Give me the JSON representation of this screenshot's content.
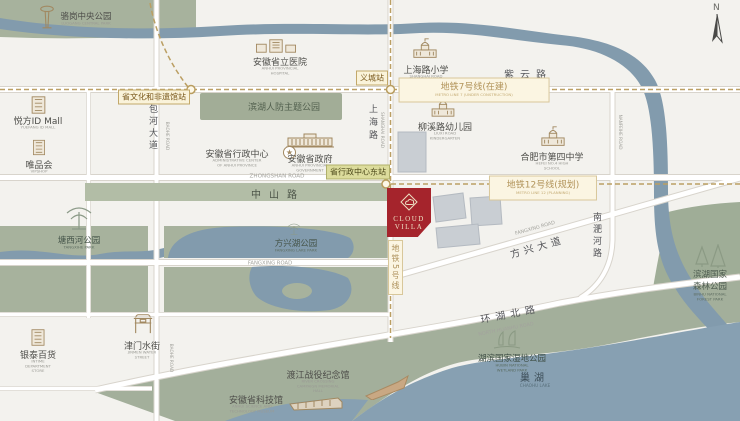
{
  "map": {
    "compass": "N",
    "badge": {
      "line1": "CLOUD",
      "line2": "VILLA"
    },
    "colors": {
      "badge_red": "#a5242c",
      "park_green": "#a7b29d",
      "water_blue": "#87a0b2",
      "metro_tan": "#bb9f63",
      "road_white": "#ffffff"
    },
    "parks": {
      "luogang": {
        "zh": "骆岗中央公园",
        "en": "LUOGANG CENTRAL PARK"
      },
      "renfang": {
        "zh": "滨湖人防主题公园"
      },
      "tangxihe": {
        "zh": "塘西河公园",
        "en": "TANGXIHE PARK"
      },
      "fangxinghu": {
        "zh": "方兴湖公园",
        "en": "FANGXING LAKE PARK"
      },
      "forest": {
        "zh": "滨湖国家森林公园",
        "en": "BINHU NATIONAL FOREST PARK"
      },
      "wetland": {
        "zh": "湖滨国家湿地公园",
        "en": "HUBIN NATIONAL WETLAND PARK"
      }
    },
    "pois": {
      "hospital": {
        "zh": "安徽省立医院",
        "en": "ANHUI PROVINCIAL HOSPITAL"
      },
      "primary": {
        "zh": "上海路小学",
        "en": "SHANGHAI ROAD PRIMARY SCHOOL"
      },
      "kindergarten": {
        "zh": "柳溪路幼儿园",
        "en": "LIUXI ROAD KINDERGARTEN"
      },
      "no4": {
        "zh": "合肥市第四中学",
        "en": "HEFEI NO.4 HIGH SCHOOL"
      },
      "yuefang": {
        "zh": "悦方ID Mall",
        "en": "YUEFANG ID MALL"
      },
      "vipshop": {
        "zh": "唯品会",
        "en": "VIPSHOP"
      },
      "intime": {
        "zh": "银泰百货",
        "en": "INTIME DEPARTMENT STORE"
      },
      "jinmen": {
        "zh": "津门水街",
        "en": "JINMEN WATER STREET"
      },
      "admin": {
        "zh": "安徽省行政中心",
        "en": "ADMINISTRATIVE CENTER OF ANHUI PROVINCE"
      },
      "gov": {
        "zh": "安徽省政府",
        "en": "ANHUI PROVINCIAL GOVERNMENT"
      },
      "memorial": {
        "zh": "渡江战役纪念馆",
        "en": "RIVER CROSSING CAMPAIGN MEMORIAL HALL"
      },
      "scitech": {
        "zh": "安徽省科技馆",
        "en": "ANHUI SCIENCE AND TECHNOLOGY MUSEUM"
      }
    },
    "roads": {
      "ziyun": {
        "zh": "紫云路",
        "en": "ZIYUN ROAD"
      },
      "zhongshan": {
        "zh": "中山路",
        "en": "ZHONGSHAN ROAD"
      },
      "shanghai": {
        "zh": "上海路",
        "en": "SHANGHAI ROAD"
      },
      "baohe": {
        "zh": "包河大道",
        "en": "BAOHE ROAD"
      },
      "fangxing_road": {
        "en": "FANGXING ROAD"
      },
      "fangxing_ave": {
        "zh": "方兴大道",
        "en": "FANGXING ROAD"
      },
      "nanfeihe": {
        "zh": "南淝河路",
        "en": "NANFEIHE ROAD"
      },
      "huanhu": {
        "zh": "环湖北路",
        "en": "NORTH HUANHU ROAD"
      }
    },
    "lake": {
      "zh": "巢湖",
      "en": "CHAOHU LAKE"
    },
    "metro": {
      "line5": {
        "zh": "地铁5号线"
      },
      "line7": {
        "zh": "地铁7号线(在建)",
        "en": "METRO LINE 7 (UNDER CONSTRUCTION)"
      },
      "line12": {
        "zh": "地铁12号线(规划)",
        "en": "METRO LINE 12 (PLANNING)"
      },
      "stations": {
        "wenhua": "省文化和非遗馆站",
        "yicheng": "义城站",
        "xingzheng": "省行政中心东站"
      }
    }
  }
}
